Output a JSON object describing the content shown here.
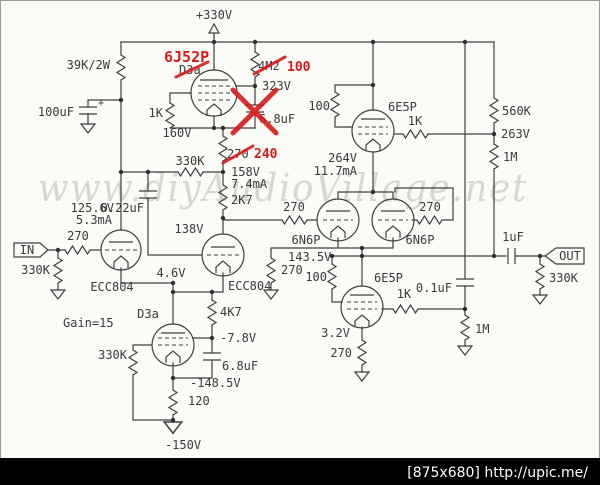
{
  "colors": {
    "schematic_line": "#3f3f3f",
    "annotation_red": "#d81a1a",
    "watermark_gray": "#d2d0cc",
    "footer_bg": "#000000",
    "footer_text": "#ffffff",
    "background": "#fbfbf8"
  },
  "watermark": "www.diyAudioVillage.net",
  "footer": "[875x680] http://upic.me/",
  "edits": {
    "tube_new": "6J52P",
    "tube_old": "D3a",
    "anode_r_old": "4M2",
    "anode_r_new": "100",
    "cathode_r_old": "270",
    "cathode_r_new": "240"
  },
  "power": {
    "b_plus": "+330V",
    "v_minus": "-150V"
  },
  "input": {
    "terminal": "IN",
    "grid_stopper": "270",
    "grid_leak": "330K",
    "tube": "ECC804",
    "anode_v": "125.6V",
    "anode_i": "5.3mA",
    "cathode_v": "4.6V",
    "gain": "Gain=15",
    "load_r": "39K/2W",
    "bypass_c": "100uF",
    "bypass_polarity": "+"
  },
  "gyrator": {
    "grid_stopper": "1K",
    "cathode_v": "160V",
    "node_v": "323V",
    "cap": "6.8uF",
    "mid_v": "158V",
    "mid_i": "7.4mA",
    "series_r": "2K7",
    "fb_r": "330K",
    "couple_c": "0.22uF"
  },
  "driver": {
    "tube": "ECC804",
    "anode_v": "138V",
    "ccs_tube": "D3a",
    "ccs_r": "4K7",
    "ccs_bias_v": "-7.8V",
    "ccs_grid_r": "330K",
    "ccs_cap": "6.8uF",
    "ccs_cathode_v": "-148.5V",
    "ccs_cathode_r": "120"
  },
  "output": {
    "tube_l": "6N6P",
    "tube_r": "6N6P",
    "grid_r_l": "270",
    "grid_r_r": "270",
    "upper_tube": "6E5P",
    "upper_g2_r": "100",
    "upper_g1_r": "1K",
    "upper_v": "264V",
    "upper_i": "11.7mA",
    "div_r_top": "560K",
    "div_v": "263V",
    "div_r_bot": "1M",
    "cathode_v": "143.5V",
    "cathode_r": "270",
    "lower_tube": "6E5P",
    "lower_g2_r": "100",
    "lower_g1_r": "1K",
    "lower_c": "0.1uF",
    "lower_r": "1M",
    "lower_k_v": "3.2V",
    "lower_k_r": "270",
    "out_c": "1uF",
    "terminal": "OUT",
    "out_r": "330K"
  }
}
